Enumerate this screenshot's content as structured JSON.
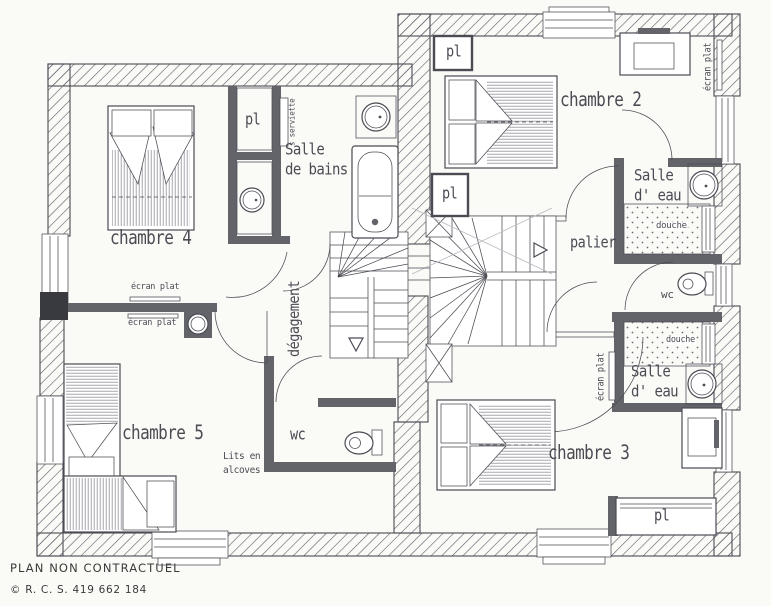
{
  "labels": {
    "chambre2": "chambre 2",
    "chambre3": "chambre 3",
    "chambre4": "chambre 4",
    "chambre5": "chambre 5",
    "salle": "Salle",
    "de_bains": "de bains",
    "d_eau": "d' eau",
    "palier": "palier",
    "degagement": "dégagement",
    "wc": "wc",
    "pl": "pl",
    "douche": "douche",
    "lits_en": "Lits en",
    "alcoves": "alcoves",
    "ecran_plat": "écran plat",
    "s_serviette": "s serviette"
  },
  "footer": {
    "line1": "PLAN NON CONTRACTUEL",
    "line2": "© R. C. S. 419 662 184"
  },
  "colors": {
    "paper": "#fafaf7",
    "line": "#4b4b54",
    "wall": "#63636a",
    "dark": "#393940",
    "hatch_line": "#5c5c66",
    "bed_hatch": "#8f8f99",
    "shower_dots": "#6d6d77"
  }
}
